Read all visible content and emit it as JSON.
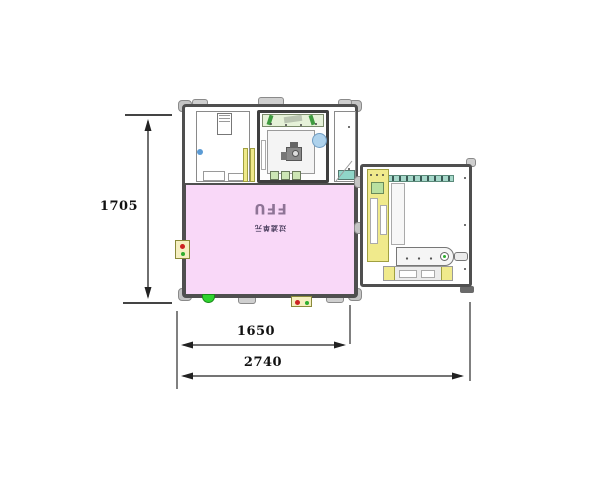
{
  "drawing": {
    "dims": {
      "height": "1705",
      "inner_width": "1650",
      "total_width": "2740"
    },
    "ffu": {
      "label": "FFU",
      "sublabel": "过滤单元"
    },
    "colors": {
      "ffu_panel_pink": "#f9d8f8",
      "frame_gray": "#4f4f4f",
      "component_yellow": "#f0ea8c",
      "rail_teal": "#a6d8ca",
      "io_strip_green": "#e6f2d8",
      "indicator_red": "#cc2222",
      "indicator_green": "#2fae2f",
      "knob_green": "#2fd32f",
      "port_blue": "#5b9bd5",
      "bowl_blue": "#aed2ec",
      "dimension_line": "#333333"
    }
  }
}
